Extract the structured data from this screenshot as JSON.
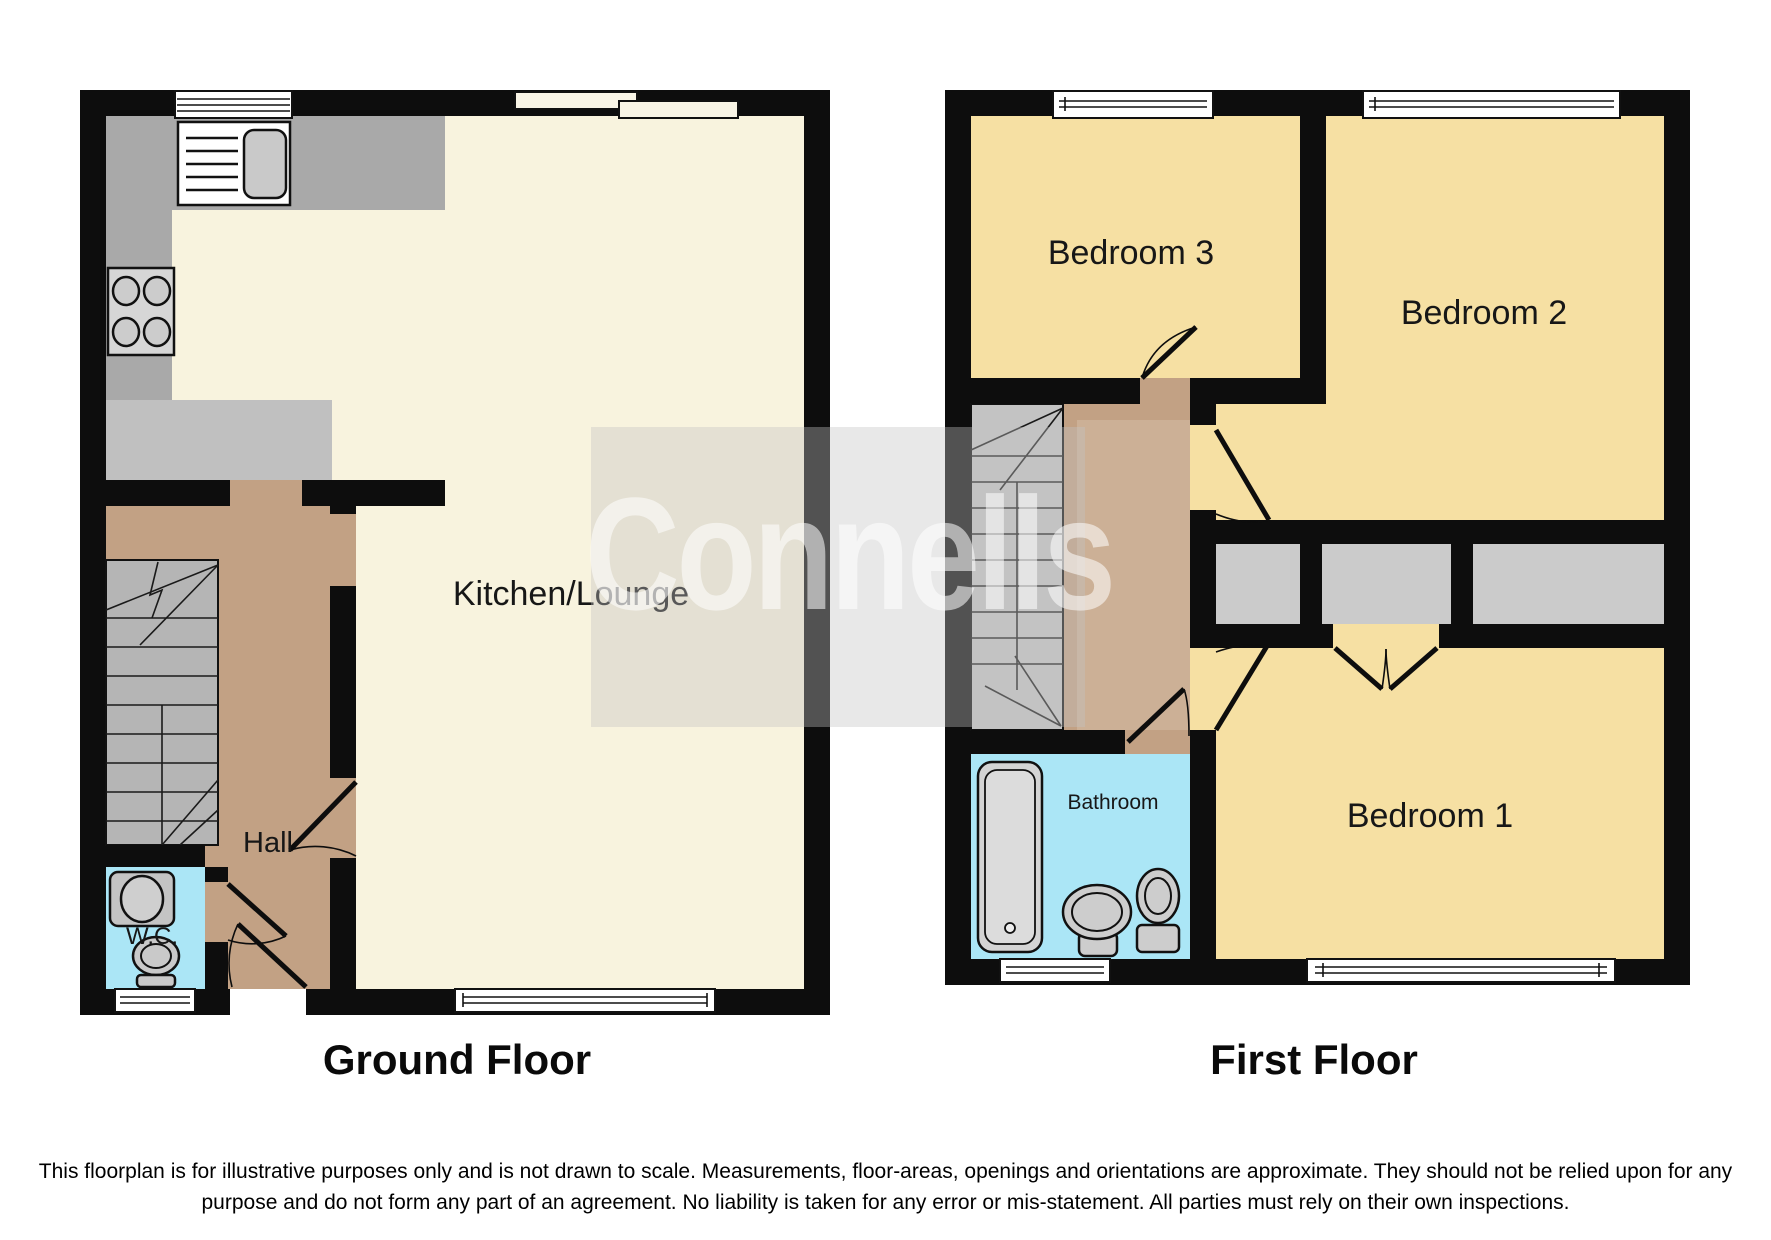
{
  "watermark": {
    "text": "Connells"
  },
  "titles": {
    "ground": "Ground Floor",
    "first": "First Floor"
  },
  "ground_floor": {
    "rooms": {
      "kitchen_lounge": "Kitchen/Lounge",
      "hall": "Hall",
      "wc": "W.C."
    }
  },
  "first_floor": {
    "rooms": {
      "bedroom1": "Bedroom 1",
      "bedroom2": "Bedroom 2",
      "bedroom3": "Bedroom 3",
      "bathroom": "Bathroom"
    }
  },
  "disclaimer": {
    "line1": "This floorplan is for illustrative purposes only and is not drawn to scale. Measurements, floor-areas, openings and orientations are approximate. They should not be relied upon for any",
    "line2": "purpose and do not form any part of an agreement. No liability is taken for any error or mis-statement. All parties must rely on their own inspections."
  },
  "colors": {
    "wall": "#0d0d0d",
    "lounge_cream": "#f8f3de",
    "bedroom_yellow": "#f6e0a3",
    "hall_brown": "#c2a184",
    "wet_room_cyan": "#abe6f6",
    "counter_gray": "#a9a9a9",
    "stairs_gray": "#bdbdbd",
    "wardrobe_gray": "#cbcbcb",
    "window_white": "#ffffff"
  }
}
